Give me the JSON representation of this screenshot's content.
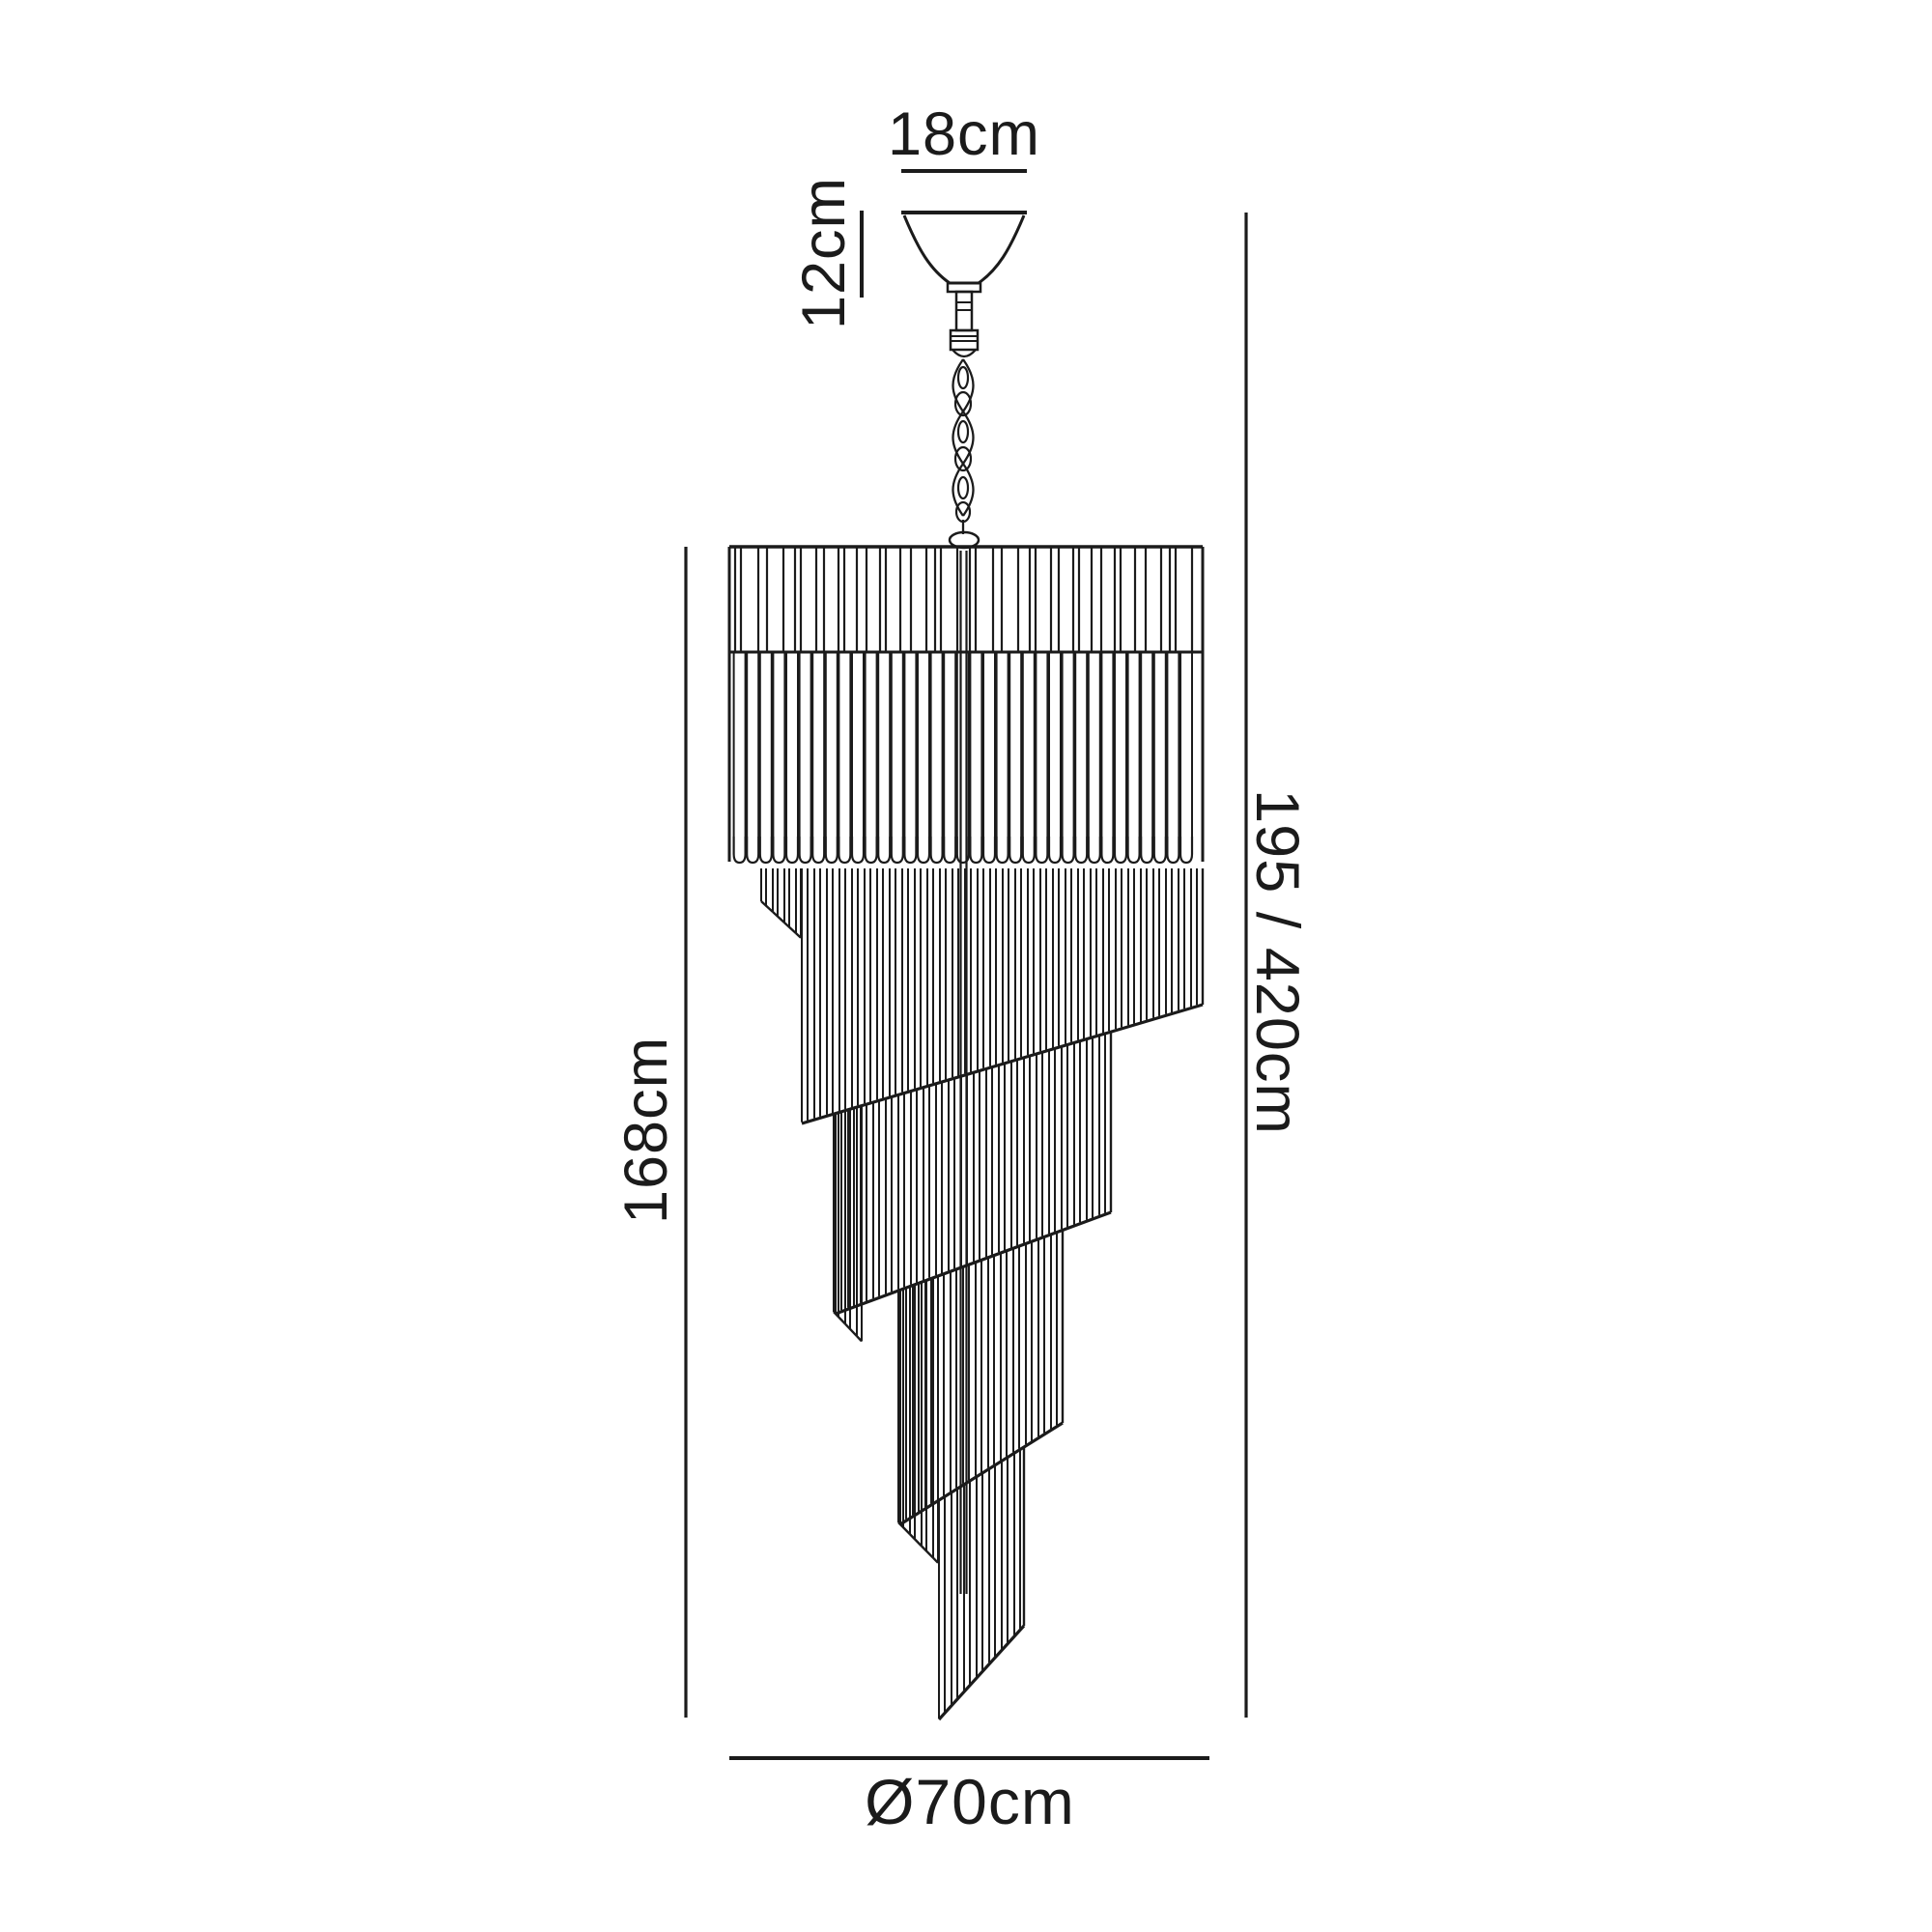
{
  "page": {
    "background": "#ffffff"
  },
  "diagram": {
    "kind": "product-dimension-drawing",
    "product": "spiral-cascade-chandelier",
    "line_color": "#1b1b1b",
    "labels": {
      "canopy_width": "18cm",
      "canopy_height": "12cm",
      "body_height": "168cm",
      "total_height": "195 / 420cm",
      "diameter": "Ø70cm"
    }
  }
}
